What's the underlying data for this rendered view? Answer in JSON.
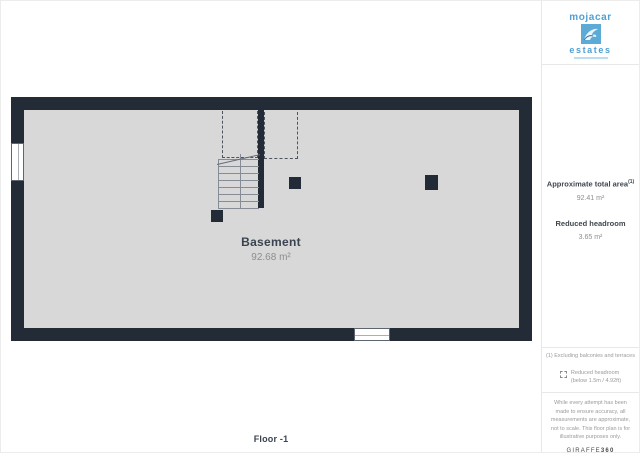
{
  "logo": {
    "brand_top": "mojacar",
    "brand_bottom": "estates"
  },
  "plan": {
    "room_name": "Basement",
    "room_area": "92.68 m²",
    "floor_label": "Floor -1"
  },
  "sidebar": {
    "approx_area_label": "Approximate total area",
    "approx_area_superscript": "(1)",
    "approx_area_value": "92.41 m²",
    "reduced_headroom_label": "Reduced headroom",
    "reduced_headroom_value": "3.65 m²",
    "footnote": "(1) Excluding balconies and terraces",
    "legend_line1": "Reduced headroom",
    "legend_line2": "(below 1.5m / 4.92ft)",
    "disclaimer": "While every attempt has been made to ensure accuracy, all measurements are approximate, not to scale. This floor plan is for illustrative purposes only.",
    "provider_brand_name": "GIRAFFE",
    "provider_brand_number": "360"
  },
  "colors": {
    "wall": "#232b37",
    "floor_fill": "#d8d8d8",
    "brand_blue": "#4fa0d4",
    "text_dark": "#3b4350",
    "text_gray": "#8d8d8d",
    "divider": "#e8e8e8"
  }
}
